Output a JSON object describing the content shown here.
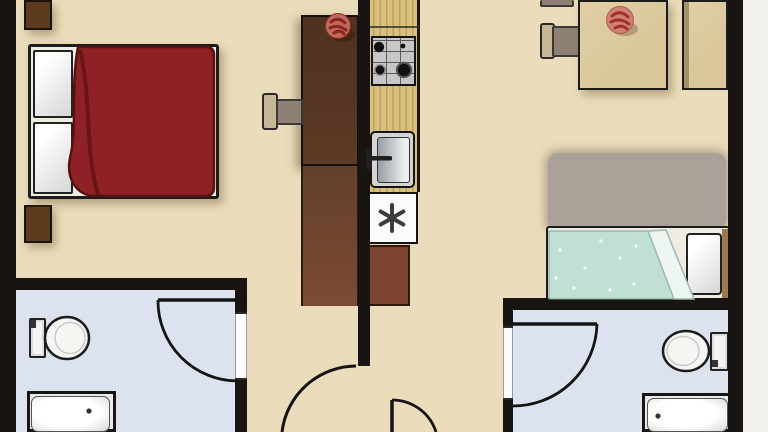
{
  "scene": {
    "type": "apartment-floor-plan",
    "width_px": 768,
    "height_px": 432,
    "orientation": "top-down",
    "visible_text": []
  },
  "colors": {
    "floor": "#ebddbb",
    "bathroom_floor": "#dce3ee",
    "wall": "#181411",
    "wood": "#d9c69b",
    "counter": "#d8c07e",
    "desk_dark": "#4e311f",
    "desk_lower": "#7d4a37",
    "cabinet_brown": "#7b4330",
    "nightstand": "#5e3b1d",
    "blanket_maroon": "#8d2125",
    "blanket_teal": "#c0e0d3",
    "rug": "#aaa299",
    "chair_seat": "#8e8173",
    "chair_back": "#c7b795",
    "rose_red": "#a03127",
    "rose_body": "#cf8274",
    "outside": "#f2f0ec"
  },
  "rooms": [
    {
      "name": "master-bedroom",
      "position": "top-left",
      "furniture": [
        "double-bed with maroon blanket and two white pillows",
        "nightstand-top",
        "nightstand-bottom",
        "tall dark-brown desk/wardrobe with chair",
        "red rose on desk"
      ]
    },
    {
      "name": "kitchen",
      "position": "center strip",
      "furniture": [
        "wood counter run",
        "4-burner gas stove",
        "single-basin sink with faucet",
        "white appliance with asterisk (freezer)",
        "red-brown lower cabinet"
      ]
    },
    {
      "name": "living-dining",
      "position": "right",
      "furniture": [
        "wood dining table with red rose",
        "dining chair",
        "partial chair at top edge",
        "wood sideboard along right wall",
        "gray area rug",
        "single bed with teal dotted blanket, white pillow at right"
      ]
    },
    {
      "name": "bathroom-left",
      "position": "bottom-left",
      "furniture": [
        "toilet with tank on left wall",
        "square shower tray with drain",
        "inward-swinging door in right wall"
      ]
    },
    {
      "name": "bathroom-right",
      "position": "bottom-right",
      "furniture": [
        "toilet with tank on right wall",
        "shower tray with drain",
        "inward-swinging door in left wall"
      ]
    },
    {
      "name": "hallway",
      "position": "bottom-center",
      "furniture": [
        "large door swing arc at bedroom opening",
        "entry door swing at bottom edge (cut off)"
      ]
    }
  ],
  "doors": {
    "count_visible": 4,
    "list": [
      "bathroom-left door",
      "bathroom-right door",
      "bedroom/hall large swing",
      "entry swing (bottom, cropped)"
    ]
  }
}
